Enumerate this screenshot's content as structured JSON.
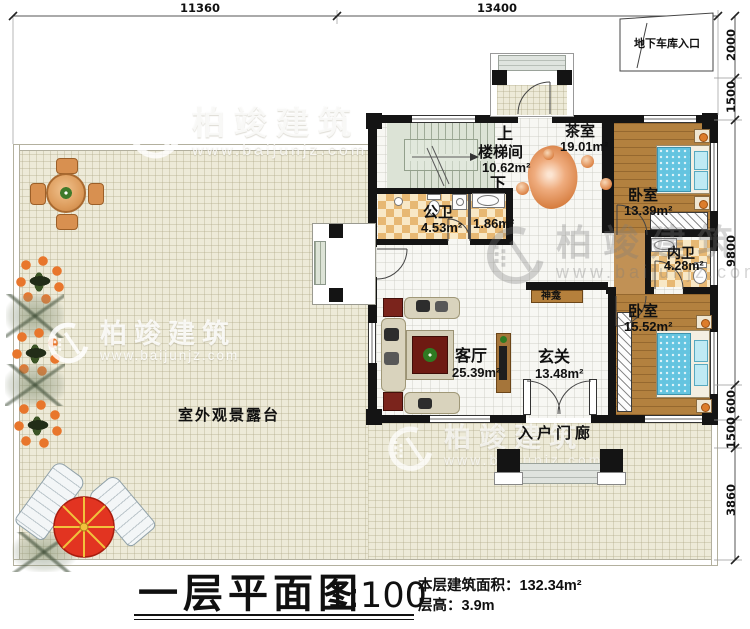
{
  "watermark": {
    "brand": "柏竣建筑",
    "url": "www.baijunjz.com"
  },
  "dimensions": {
    "top": [
      {
        "value": "11360"
      },
      {
        "value": "13400"
      }
    ],
    "right": [
      {
        "value": "2000"
      },
      {
        "value": "1500"
      },
      {
        "value": "9800"
      },
      {
        "value": "600"
      },
      {
        "value": "1500"
      },
      {
        "value": "3860"
      }
    ]
  },
  "annotations": {
    "garage_entry": "地下车库入口"
  },
  "rooms": {
    "stairwell": {
      "name": "楼梯间",
      "area": "10.62m²",
      "up": "上",
      "down": "下"
    },
    "tea_room": {
      "name": "茶室",
      "area": "19.01m²"
    },
    "bedroom_top": {
      "name": "卧室",
      "area": "13.39m²"
    },
    "public_bath": {
      "name": "公卫",
      "area": "4.53m²"
    },
    "utility": {
      "area": "1.86m²"
    },
    "ensuite_bath": {
      "name": "内卫",
      "area": "4.28m²"
    },
    "living_room": {
      "name": "客厅",
      "area": "25.39m²"
    },
    "foyer": {
      "name": "玄关",
      "area": "13.48m²"
    },
    "bedroom_bottom": {
      "name": "卧室",
      "area": "15.52m²"
    },
    "shrine": {
      "name": "神龛"
    },
    "entry_porch": {
      "name": "入户门廊"
    },
    "terrace": {
      "name": "室外观景露台"
    }
  },
  "title_block": {
    "plan_title": "一层平面图",
    "scale": "1:100",
    "floor_area_label": "本层建筑面积：",
    "floor_area_value": "132.34m²",
    "floor_height_label": "层高：",
    "floor_height_value": "3.9m"
  }
}
